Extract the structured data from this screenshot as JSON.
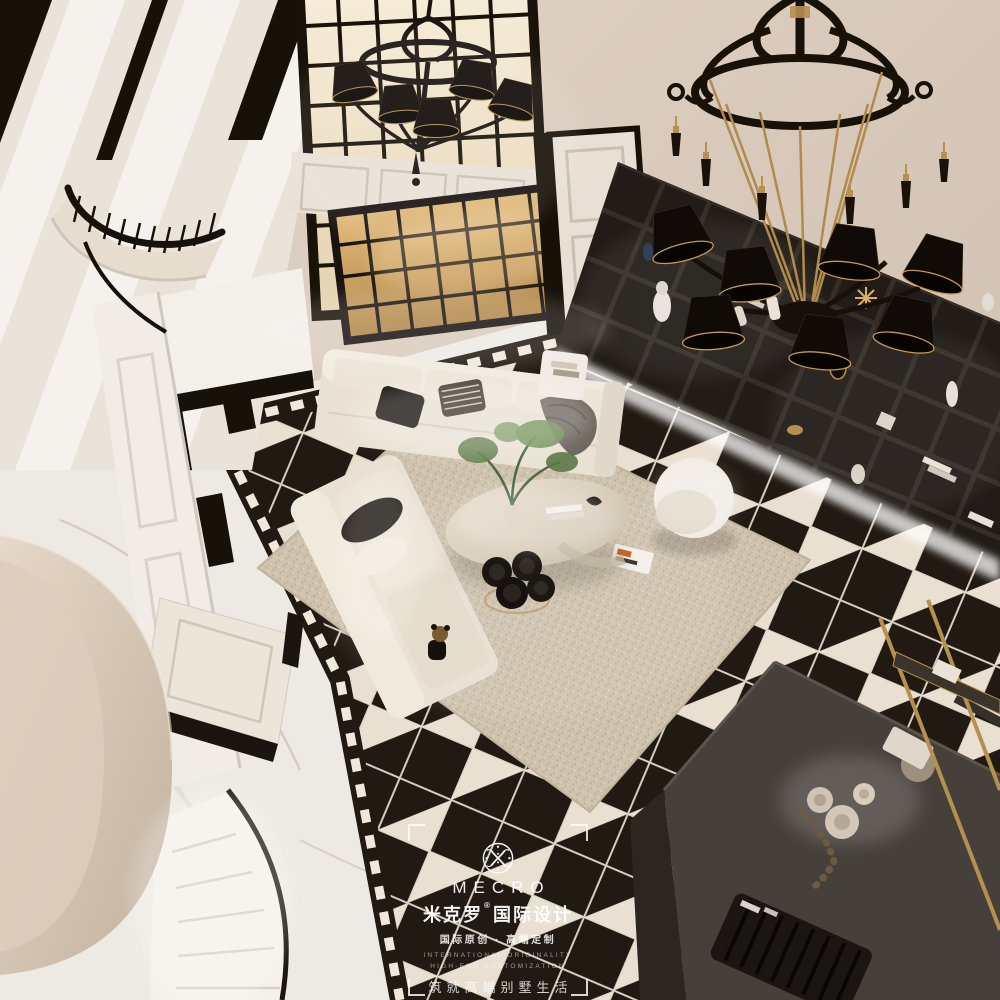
{
  "watermark": {
    "brand_en": "MECRO",
    "brand_cn": "米克罗",
    "registered_mark": "®",
    "brand_suffix_cn": "国际设计",
    "tagline_cn": "国际原创 · 高端定制",
    "tagline_en_line1": "INTERNATIONAL ORIGINALITY",
    "tagline_en_line2": "HIGH-END CUSTOMIZATION",
    "slogan_cn": "筑就高端别墅生活",
    "logo_monogram": "ornate-x-in-circle"
  },
  "scene": {
    "colors": {
      "wall": "#d3c4b7",
      "wall_light": "#e8ddd0",
      "cream": "#f0ebe3",
      "black": "#171209",
      "soft_black": "#2a221a",
      "gold": "#b5904e",
      "gold_light": "#d9b06a",
      "glass_warm": "#f2e4c8",
      "glass_amber": "#d2a968",
      "marble": "#edeae4",
      "vein": "#c8c0b4",
      "tile_white": "#e9e0d1",
      "tile_black": "#211a12",
      "rug": "#cfc2ae",
      "rug_dot": "#bdae98",
      "sofa": "#e9e2d4",
      "shelf": "#16100b",
      "shelf_line": "#2b231b",
      "stair_beige": "#d8c8b8",
      "plant": "#5f7d4a"
    }
  }
}
